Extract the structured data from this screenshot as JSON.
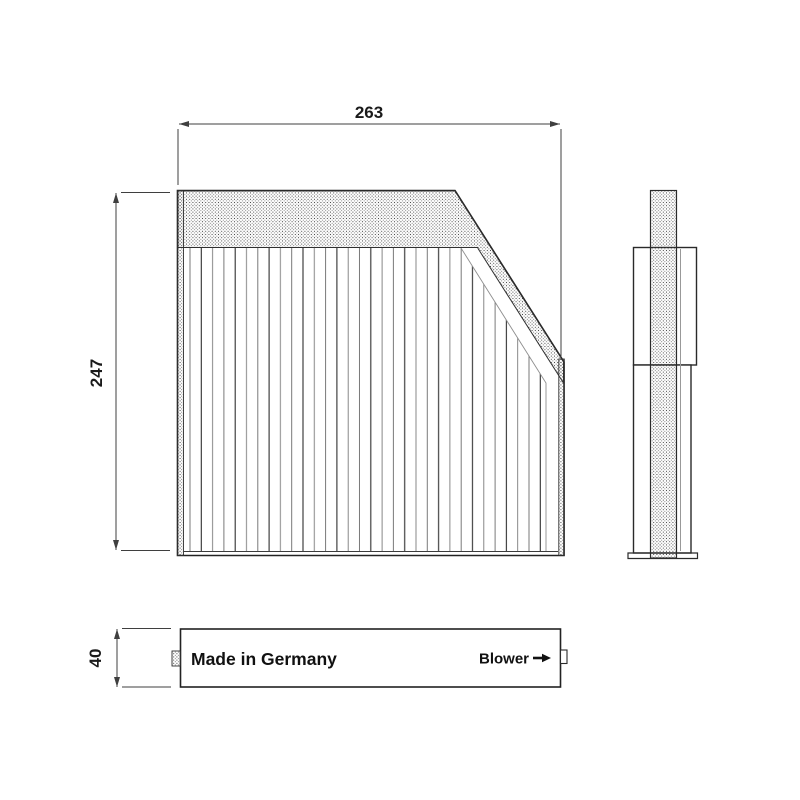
{
  "views": {
    "front": {
      "width_dim": "263",
      "height_dim": "247"
    },
    "bottom": {
      "depth_dim": "40",
      "made_in_label": "Made in Germany",
      "blower_label": "Blower"
    }
  },
  "colors": {
    "background": "#ffffff",
    "outline": "#222222",
    "dimension_line": "#3f3f3f",
    "hatch_dot": "#3a3a3a",
    "pleat_line": "#2f2f2f",
    "text": "#111111"
  }
}
